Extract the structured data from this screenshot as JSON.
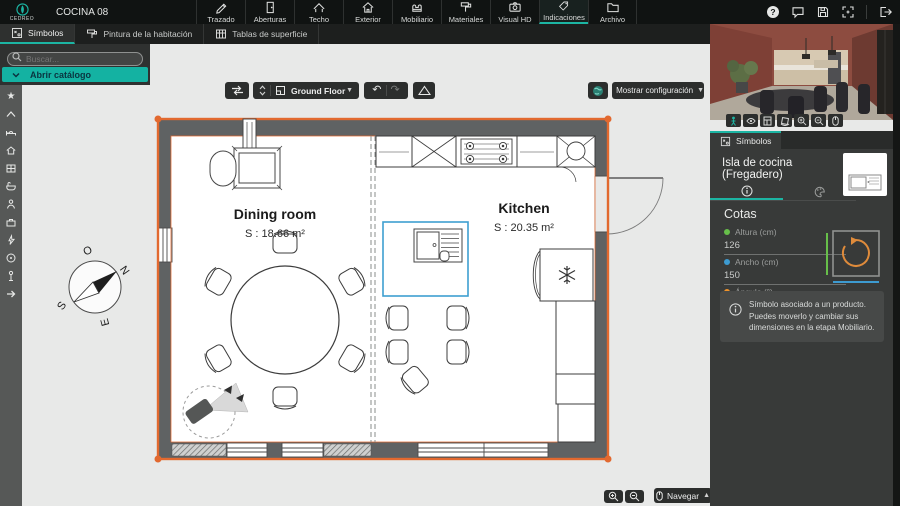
{
  "colors": {
    "accent_teal": "#1cb5a3",
    "selection_orange": "#e2692f",
    "selection_blue": "#3e9fd0",
    "dot_green": "#67bf4a",
    "dot_blue": "#3d9bd1",
    "dot_orange": "#f0932a"
  },
  "topbar": {
    "brand": "CEDREO",
    "project": "COCINA 08",
    "menu": [
      {
        "label": "Trazado",
        "icon": "pencil-icon"
      },
      {
        "label": "Aberturas",
        "icon": "door-icon"
      },
      {
        "label": "Techo",
        "icon": "roof-icon"
      },
      {
        "label": "Exterior",
        "icon": "house-icon"
      },
      {
        "label": "Mobiliario",
        "icon": "furniture-icon"
      },
      {
        "label": "Materiales",
        "icon": "paint-roller-icon"
      },
      {
        "label": "Visual HD",
        "icon": "camera-icon"
      },
      {
        "label": "Indicaciones",
        "icon": "tag-icon",
        "active": true
      },
      {
        "label": "Archivo",
        "icon": "folder-icon"
      }
    ],
    "actions": [
      "help",
      "comments",
      "save",
      "fit-view",
      "exit"
    ]
  },
  "subtabs": {
    "items": [
      {
        "label": "Símbolos",
        "icon": "symbols-icon",
        "active": true
      },
      {
        "label": "Pintura de la habitación",
        "icon": "paint-icon"
      },
      {
        "label": "Tablas de superficie",
        "icon": "table-icon"
      }
    ]
  },
  "catalog": {
    "search_placeholder": "Buscar...",
    "open_button": "Abrir catálogo"
  },
  "rail_icons": [
    "star",
    "roof",
    "bed",
    "house",
    "cabinet",
    "bathtub",
    "person",
    "toolbox",
    "lightning",
    "target",
    "lamp",
    "arrow-right"
  ],
  "canvas_toolbar": {
    "floor": "Ground Floor",
    "show_config": "Mostrar configuración"
  },
  "plan": {
    "rooms": [
      {
        "name": "Dining room",
        "area": "S : 18.66 m²"
      },
      {
        "name": "Kitchen",
        "area": "S : 20.35 m²"
      }
    ],
    "compass": {
      "west": "O",
      "north": "N",
      "east": "E",
      "south": "S"
    }
  },
  "bottom_controls": {
    "navigate": "Navegar"
  },
  "preview_toolbar": [
    "walk",
    "eye",
    "layout",
    "orbit",
    "zoom-in",
    "zoom-out",
    "mouse"
  ],
  "panel": {
    "tab": "Símbolos",
    "title": "Isla de cocina (Fregadero)",
    "section": "Cotas",
    "fields": [
      {
        "label": "Altura (cm)",
        "value": "126"
      },
      {
        "label": "Ancho (cm)",
        "value": "150"
      },
      {
        "label": "Ángulo (°)",
        "value": "180"
      }
    ],
    "info": "Símbolo asociado a un producto.\nPuedes moverlo y cambiar sus dimensiones en la etapa Mobiliario."
  }
}
